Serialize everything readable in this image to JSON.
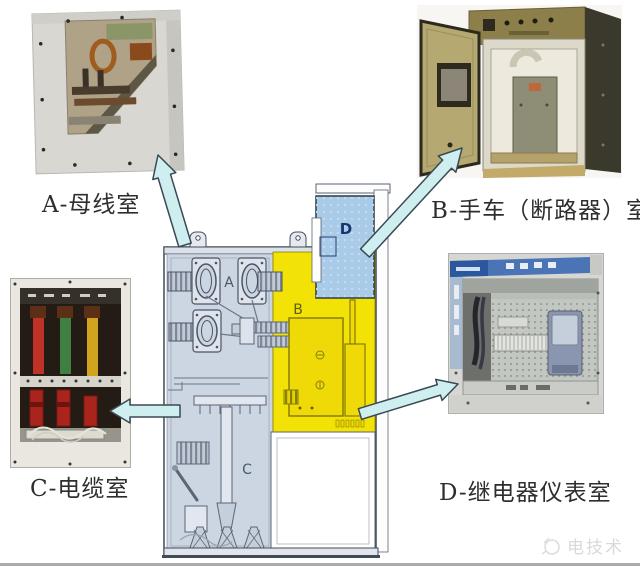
{
  "figure": {
    "description_letters": [
      "A",
      "B",
      "C",
      "D"
    ]
  },
  "compartments": {
    "a": {
      "letter": "A",
      "label": "A-母线室"
    },
    "b": {
      "letter": "B",
      "label": "B-手车（断路器）室"
    },
    "c": {
      "letter": "C",
      "label": "C-电缆室"
    },
    "d": {
      "letter": "D",
      "label": "D-继电器仪表室"
    }
  },
  "colors": {
    "busbar_cable_region_fill": "#ccd5e2",
    "breaker_region_fill": "#f2e205",
    "relay_box_fill": "#a9cbe8",
    "arrow_fill": "#cfeef0",
    "outline": "#3f4b57"
  },
  "watermark": {
    "text": "电技术"
  }
}
